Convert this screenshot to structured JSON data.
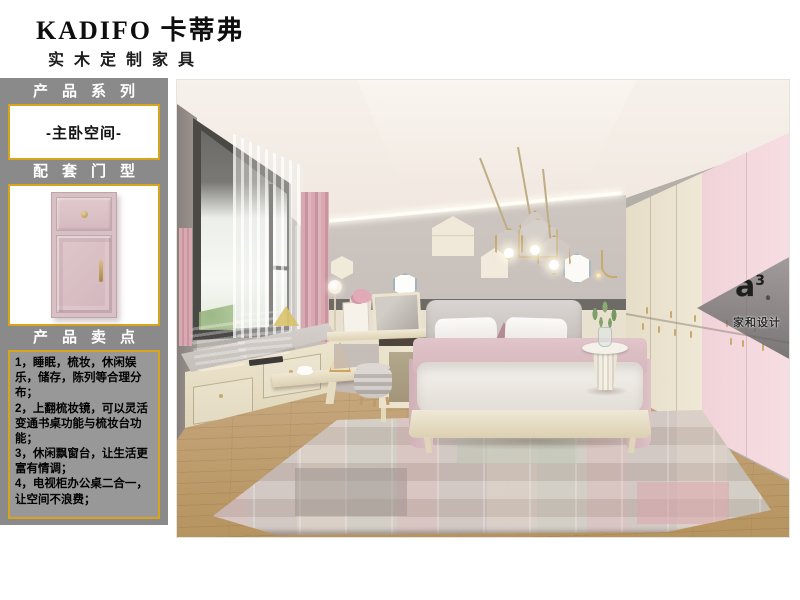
{
  "brand": {
    "name": "KADIFO 卡蒂弗",
    "tagline": "实木定制家具"
  },
  "sidebar": {
    "heading_series": "产品系列",
    "series_value": "-主卧空间-",
    "heading_door": "配套门型",
    "heading_points": "产品卖点",
    "points": [
      "1，睡眠，梳妆，休闲娱乐，储存，陈列等合理分布；",
      "2，上翻梳妆镜，可以灵活变通书桌功能与梳妆台功能；",
      "3，休闲飘窗台，让生活更富有情调；",
      "4，电视柜办公桌二合一，让空间不浪费；"
    ]
  },
  "watermark": {
    "mark": "a",
    "mark_sup": "3",
    "reg": "®",
    "name": "家和设计"
  },
  "colors": {
    "sidebar_bg": "#8a8a8a",
    "accent_gold": "#d7a41c",
    "door_pink": "#d9c0c5",
    "wardrobe_pink": "#f3d6dc",
    "wardrobe_cream": "#ebe3cf",
    "wall_gray": "#c6bfba",
    "curtain_pink": "#d3a0ab",
    "floor_wood": "#c2a276"
  }
}
